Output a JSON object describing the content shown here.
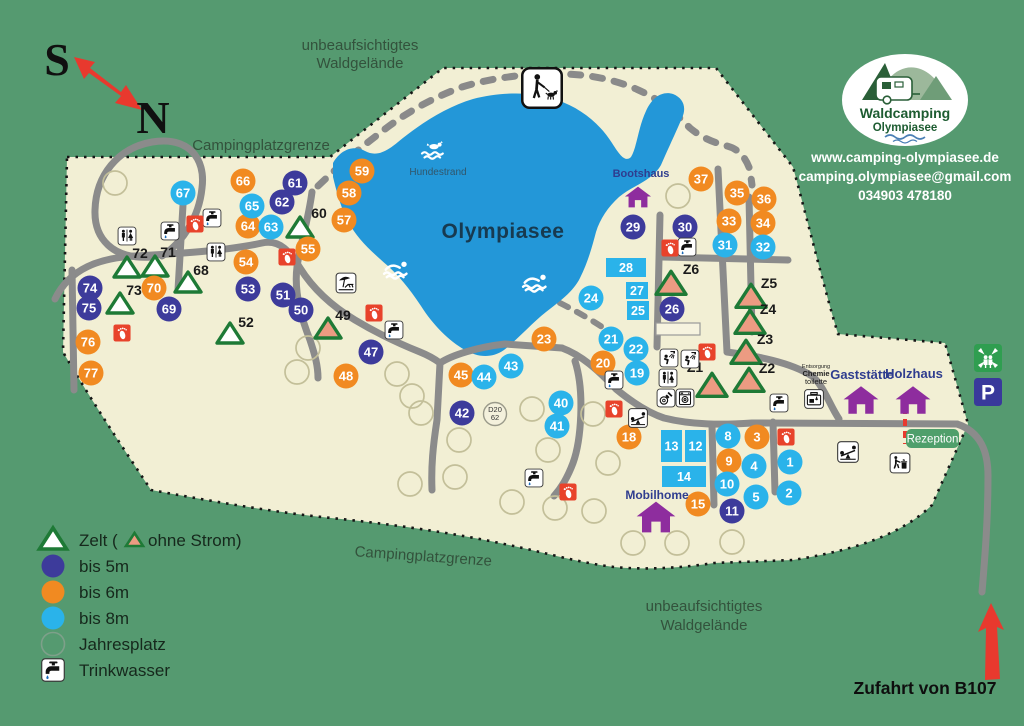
{
  "compass": {
    "south": "S",
    "north": "N"
  },
  "area_labels": {
    "forest_top_1": "unbeaufsichtigtes",
    "forest_top_2": "Waldgelände",
    "boundary_top": "Campingplatzgrenze",
    "boundary_bottom": "Campingplatzgrenze",
    "forest_bottom_1": "unbeaufsichtigtes",
    "forest_bottom_2": "Waldgelände"
  },
  "lake": {
    "name": "Olympiasee",
    "dog_beach_label": "Hundestrand"
  },
  "logo": {
    "name_line1": "Waldcamping",
    "name_line2": "Olympiasee"
  },
  "contact": {
    "website": "www.camping-olympiasee.de",
    "email": "camping.olympiasee@gmail.com",
    "phone": "034903 478180"
  },
  "entrance": {
    "label": "Zufahrt von B107"
  },
  "reception": {
    "label": "Rezeption"
  },
  "disposal": {
    "line1": "Entsorgung",
    "line2": "Chemie",
    "line3": "toilette"
  },
  "road_marker": {
    "line1": "D20",
    "line2": "62"
  },
  "legend": {
    "zelt_prefix": "Zelt (",
    "zelt_suffix": "ohne Strom)",
    "bis5": "bis 5m",
    "bis6": "bis 6m",
    "bis8": "bis 8m",
    "jahresplatz": "Jahresplatz",
    "trinkwasser": "Trinkwasser"
  },
  "colors": {
    "background_green": "#559a70",
    "campground_cream": "#f2efd4",
    "lake_blue": "#2397d8",
    "site_5m": "#3d3b9b",
    "site_6m": "#f18a21",
    "site_8m": "#2ab3ea",
    "tent_green": "#1e7a36",
    "tent_no_power": "#ec9b82",
    "road_gray": "#8b8b8b",
    "building_purple": "#8e2d9e",
    "marker_red": "#e8432b",
    "reception_green": "#4f9f6b",
    "parking_blue": "#39399b",
    "assembly_green": "#2f9e50"
  },
  "buildings": [
    {
      "label": "Bootshaus",
      "x": 638,
      "y": 197,
      "s": 27,
      "lx": 641,
      "ly": 177,
      "fs": 11
    },
    {
      "label": "Gaststätte",
      "x": 861,
      "y": 400,
      "s": 36,
      "lx": 862,
      "ly": 379,
      "fs": 13
    },
    {
      "label": "Holzhaus",
      "x": 913,
      "y": 400,
      "s": 36,
      "lx": 914,
      "ly": 378,
      "fs": 13
    },
    {
      "label": "Mobilhome",
      "x": 656,
      "y": 517,
      "s": 40,
      "lx": 657,
      "ly": 499,
      "fs": 12
    }
  ],
  "sites": [
    {
      "n": "61",
      "x": 295,
      "y": 183,
      "c": "5"
    },
    {
      "n": "62",
      "x": 282,
      "y": 202,
      "c": "5"
    },
    {
      "n": "74",
      "x": 90,
      "y": 288,
      "c": "5"
    },
    {
      "n": "75",
      "x": 89,
      "y": 308,
      "c": "5"
    },
    {
      "n": "69",
      "x": 169,
      "y": 309,
      "c": "5"
    },
    {
      "n": "53",
      "x": 248,
      "y": 289,
      "c": "5"
    },
    {
      "n": "51",
      "x": 283,
      "y": 295,
      "c": "5"
    },
    {
      "n": "50",
      "x": 301,
      "y": 310,
      "c": "5"
    },
    {
      "n": "47",
      "x": 371,
      "y": 352,
      "c": "5"
    },
    {
      "n": "42",
      "x": 462,
      "y": 413,
      "c": "5"
    },
    {
      "n": "26",
      "x": 672,
      "y": 309,
      "c": "5"
    },
    {
      "n": "29",
      "x": 633,
      "y": 227,
      "c": "5"
    },
    {
      "n": "30",
      "x": 685,
      "y": 227,
      "c": "5"
    },
    {
      "n": "11",
      "x": 732,
      "y": 511,
      "c": "5"
    },
    {
      "n": "66",
      "x": 243,
      "y": 181,
      "c": "6"
    },
    {
      "n": "64",
      "x": 248,
      "y": 226,
      "c": "6"
    },
    {
      "n": "55",
      "x": 308,
      "y": 249,
      "c": "6"
    },
    {
      "n": "54",
      "x": 246,
      "y": 262,
      "c": "6"
    },
    {
      "n": "70",
      "x": 154,
      "y": 288,
      "c": "6"
    },
    {
      "n": "76",
      "x": 88,
      "y": 342,
      "c": "6"
    },
    {
      "n": "77",
      "x": 91,
      "y": 373,
      "c": "6"
    },
    {
      "n": "59",
      "x": 362,
      "y": 171,
      "c": "6"
    },
    {
      "n": "58",
      "x": 349,
      "y": 193,
      "c": "6"
    },
    {
      "n": "57",
      "x": 344,
      "y": 220,
      "c": "6"
    },
    {
      "n": "48",
      "x": 346,
      "y": 376,
      "c": "6"
    },
    {
      "n": "45",
      "x": 461,
      "y": 375,
      "c": "6"
    },
    {
      "n": "23",
      "x": 544,
      "y": 339,
      "c": "6"
    },
    {
      "n": "20",
      "x": 603,
      "y": 363,
      "c": "6"
    },
    {
      "n": "18",
      "x": 629,
      "y": 437,
      "c": "6"
    },
    {
      "n": "37",
      "x": 701,
      "y": 179,
      "c": "6"
    },
    {
      "n": "35",
      "x": 737,
      "y": 193,
      "c": "6"
    },
    {
      "n": "36",
      "x": 764,
      "y": 199,
      "c": "6"
    },
    {
      "n": "33",
      "x": 729,
      "y": 221,
      "c": "6"
    },
    {
      "n": "34",
      "x": 763,
      "y": 223,
      "c": "6"
    },
    {
      "n": "15",
      "x": 698,
      "y": 504,
      "c": "6"
    },
    {
      "n": "9",
      "x": 729,
      "y": 461,
      "c": "6"
    },
    {
      "n": "3",
      "x": 757,
      "y": 437,
      "c": "6"
    },
    {
      "n": "67",
      "x": 183,
      "y": 193,
      "c": "8"
    },
    {
      "n": "65",
      "x": 252,
      "y": 206,
      "c": "8"
    },
    {
      "n": "63",
      "x": 271,
      "y": 227,
      "c": "8"
    },
    {
      "n": "24",
      "x": 591,
      "y": 298,
      "c": "8"
    },
    {
      "n": "43",
      "x": 511,
      "y": 366,
      "c": "8"
    },
    {
      "n": "44",
      "x": 484,
      "y": 377,
      "c": "8"
    },
    {
      "n": "40",
      "x": 561,
      "y": 403,
      "c": "8"
    },
    {
      "n": "41",
      "x": 557,
      "y": 426,
      "c": "8"
    },
    {
      "n": "21",
      "x": 611,
      "y": 339,
      "c": "8"
    },
    {
      "n": "22",
      "x": 636,
      "y": 349,
      "c": "8"
    },
    {
      "n": "19",
      "x": 637,
      "y": 373,
      "c": "8"
    },
    {
      "n": "31",
      "x": 725,
      "y": 245,
      "c": "8"
    },
    {
      "n": "32",
      "x": 763,
      "y": 247,
      "c": "8"
    },
    {
      "n": "8",
      "x": 728,
      "y": 436,
      "c": "8"
    },
    {
      "n": "4",
      "x": 754,
      "y": 466,
      "c": "8"
    },
    {
      "n": "1",
      "x": 790,
      "y": 462,
      "c": "8"
    },
    {
      "n": "10",
      "x": 727,
      "y": 484,
      "c": "8"
    },
    {
      "n": "5",
      "x": 756,
      "y": 497,
      "c": "8"
    },
    {
      "n": "2",
      "x": 789,
      "y": 493,
      "c": "8"
    }
  ],
  "rect_sites": [
    {
      "n": "28",
      "x": 606,
      "y": 258,
      "w": 40,
      "h": 19
    },
    {
      "n": "27",
      "x": 626,
      "y": 282,
      "w": 22,
      "h": 17
    },
    {
      "n": "25",
      "x": 627,
      "y": 301,
      "w": 22,
      "h": 19
    },
    {
      "n": "13",
      "x": 661,
      "y": 430,
      "w": 21,
      "h": 32
    },
    {
      "n": "12",
      "x": 685,
      "y": 430,
      "w": 21,
      "h": 32
    },
    {
      "n": "14",
      "x": 662,
      "y": 466,
      "w": 44,
      "h": 21
    }
  ],
  "tents": [
    {
      "label": "72",
      "x": 127,
      "y": 268,
      "fill": "white",
      "lx": 140,
      "ly": 258
    },
    {
      "label": "71",
      "x": 155,
      "y": 267,
      "fill": "white",
      "lx": 168,
      "ly": 257
    },
    {
      "label": "68",
      "x": 188,
      "y": 283,
      "fill": "white",
      "lx": 201,
      "ly": 275
    },
    {
      "label": "73",
      "x": 120,
      "y": 304,
      "fill": "white",
      "lx": 134,
      "ly": 295
    },
    {
      "label": "60",
      "x": 300,
      "y": 228,
      "fill": "white",
      "lx": 319,
      "ly": 218
    },
    {
      "label": "52",
      "x": 230,
      "y": 334,
      "fill": "white",
      "lx": 246,
      "ly": 327
    },
    {
      "label": "49",
      "x": 328,
      "y": 329,
      "fill": "salmon",
      "lx": 343,
      "ly": 320
    },
    {
      "label": "Z6",
      "x": 671,
      "y": 284,
      "fill": "salmon",
      "lx": 691,
      "ly": 274
    },
    {
      "label": "Z5",
      "x": 751,
      "y": 297,
      "fill": "salmon",
      "lx": 769,
      "ly": 288
    },
    {
      "label": "Z4",
      "x": 750,
      "y": 323,
      "fill": "salmon",
      "lx": 768,
      "ly": 314
    },
    {
      "label": "Z3",
      "x": 746,
      "y": 353,
      "fill": "salmon",
      "lx": 765,
      "ly": 344
    },
    {
      "label": "Z2",
      "x": 749,
      "y": 381,
      "fill": "salmon",
      "lx": 767,
      "ly": 373
    },
    {
      "label": "Z1",
      "x": 712,
      "y": 386,
      "fill": "salmon",
      "lx": 695,
      "ly": 372
    }
  ],
  "year_pitches": [
    [
      115,
      183
    ],
    [
      678,
      196
    ],
    [
      308,
      348
    ],
    [
      297,
      372
    ],
    [
      397,
      374
    ],
    [
      412,
      396
    ],
    [
      421,
      413
    ],
    [
      459,
      440
    ],
    [
      532,
      409
    ],
    [
      548,
      450
    ],
    [
      593,
      414
    ],
    [
      608,
      463
    ],
    [
      410,
      484
    ],
    [
      455,
      477
    ],
    [
      512,
      502
    ],
    [
      555,
      508
    ],
    [
      594,
      511
    ],
    [
      633,
      543
    ],
    [
      677,
      543
    ],
    [
      732,
      542
    ]
  ],
  "icons": [
    {
      "name": "toilets-icon",
      "x": 127,
      "y": 236,
      "s": 19
    },
    {
      "name": "toilets-icon",
      "x": 216,
      "y": 252,
      "s": 19
    },
    {
      "name": "toilets-icon",
      "x": 668,
      "y": 378,
      "s": 19
    },
    {
      "name": "water-tap-icon",
      "x": 170,
      "y": 231,
      "s": 19
    },
    {
      "name": "water-tap-icon",
      "x": 212,
      "y": 218,
      "s": 19
    },
    {
      "name": "water-tap-icon",
      "x": 394,
      "y": 330,
      "s": 19
    },
    {
      "name": "water-tap-icon",
      "x": 534,
      "y": 478,
      "s": 19
    },
    {
      "name": "water-tap-icon",
      "x": 614,
      "y": 380,
      "s": 19
    },
    {
      "name": "water-tap-icon",
      "x": 687,
      "y": 247,
      "s": 19
    },
    {
      "name": "water-tap-icon",
      "x": 779,
      "y": 403,
      "s": 19
    },
    {
      "name": "footpath-icon",
      "x": 195,
      "y": 224,
      "s": 18
    },
    {
      "name": "footpath-icon",
      "x": 287,
      "y": 257,
      "s": 18
    },
    {
      "name": "footpath-icon",
      "x": 122,
      "y": 333,
      "s": 18
    },
    {
      "name": "footpath-icon",
      "x": 374,
      "y": 313,
      "s": 18
    },
    {
      "name": "footpath-icon",
      "x": 614,
      "y": 409,
      "s": 18
    },
    {
      "name": "footpath-icon",
      "x": 568,
      "y": 492,
      "s": 18
    },
    {
      "name": "footpath-icon",
      "x": 670,
      "y": 248,
      "s": 18
    },
    {
      "name": "footpath-icon",
      "x": 707,
      "y": 352,
      "s": 18
    },
    {
      "name": "footpath-icon",
      "x": 786,
      "y": 437,
      "s": 18
    },
    {
      "name": "shower-icon",
      "x": 669,
      "y": 358,
      "s": 19
    },
    {
      "name": "shower-icon",
      "x": 690,
      "y": 359,
      "s": 19
    },
    {
      "name": "dishwashing-icon",
      "x": 666,
      "y": 398,
      "s": 19
    },
    {
      "name": "washing-machine-icon",
      "x": 685,
      "y": 398,
      "s": 19
    },
    {
      "name": "playground-icon",
      "x": 638,
      "y": 418,
      "s": 20
    },
    {
      "name": "playground-icon",
      "x": 848,
      "y": 452,
      "s": 22
    },
    {
      "name": "waste-disposal-icon",
      "x": 900,
      "y": 463,
      "s": 21
    },
    {
      "name": "chemical-toilet-icon",
      "x": 814,
      "y": 399,
      "s": 20
    },
    {
      "name": "beach-icon",
      "x": 346,
      "y": 283,
      "s": 21
    },
    {
      "name": "dog-walking-icon",
      "x": 542,
      "y": 88,
      "s": 42
    },
    {
      "name": "assembly-point-icon",
      "x": 988,
      "y": 358,
      "s": 28
    },
    {
      "name": "parking-icon",
      "x": 988,
      "y": 392,
      "s": 28
    },
    {
      "name": "swimmer-icon",
      "x": 397,
      "y": 269,
      "s": 28
    },
    {
      "name": "swimmer-icon",
      "x": 536,
      "y": 282,
      "s": 28
    },
    {
      "name": "dog-swimming-icon",
      "x": 435,
      "y": 150,
      "s": 30
    }
  ]
}
